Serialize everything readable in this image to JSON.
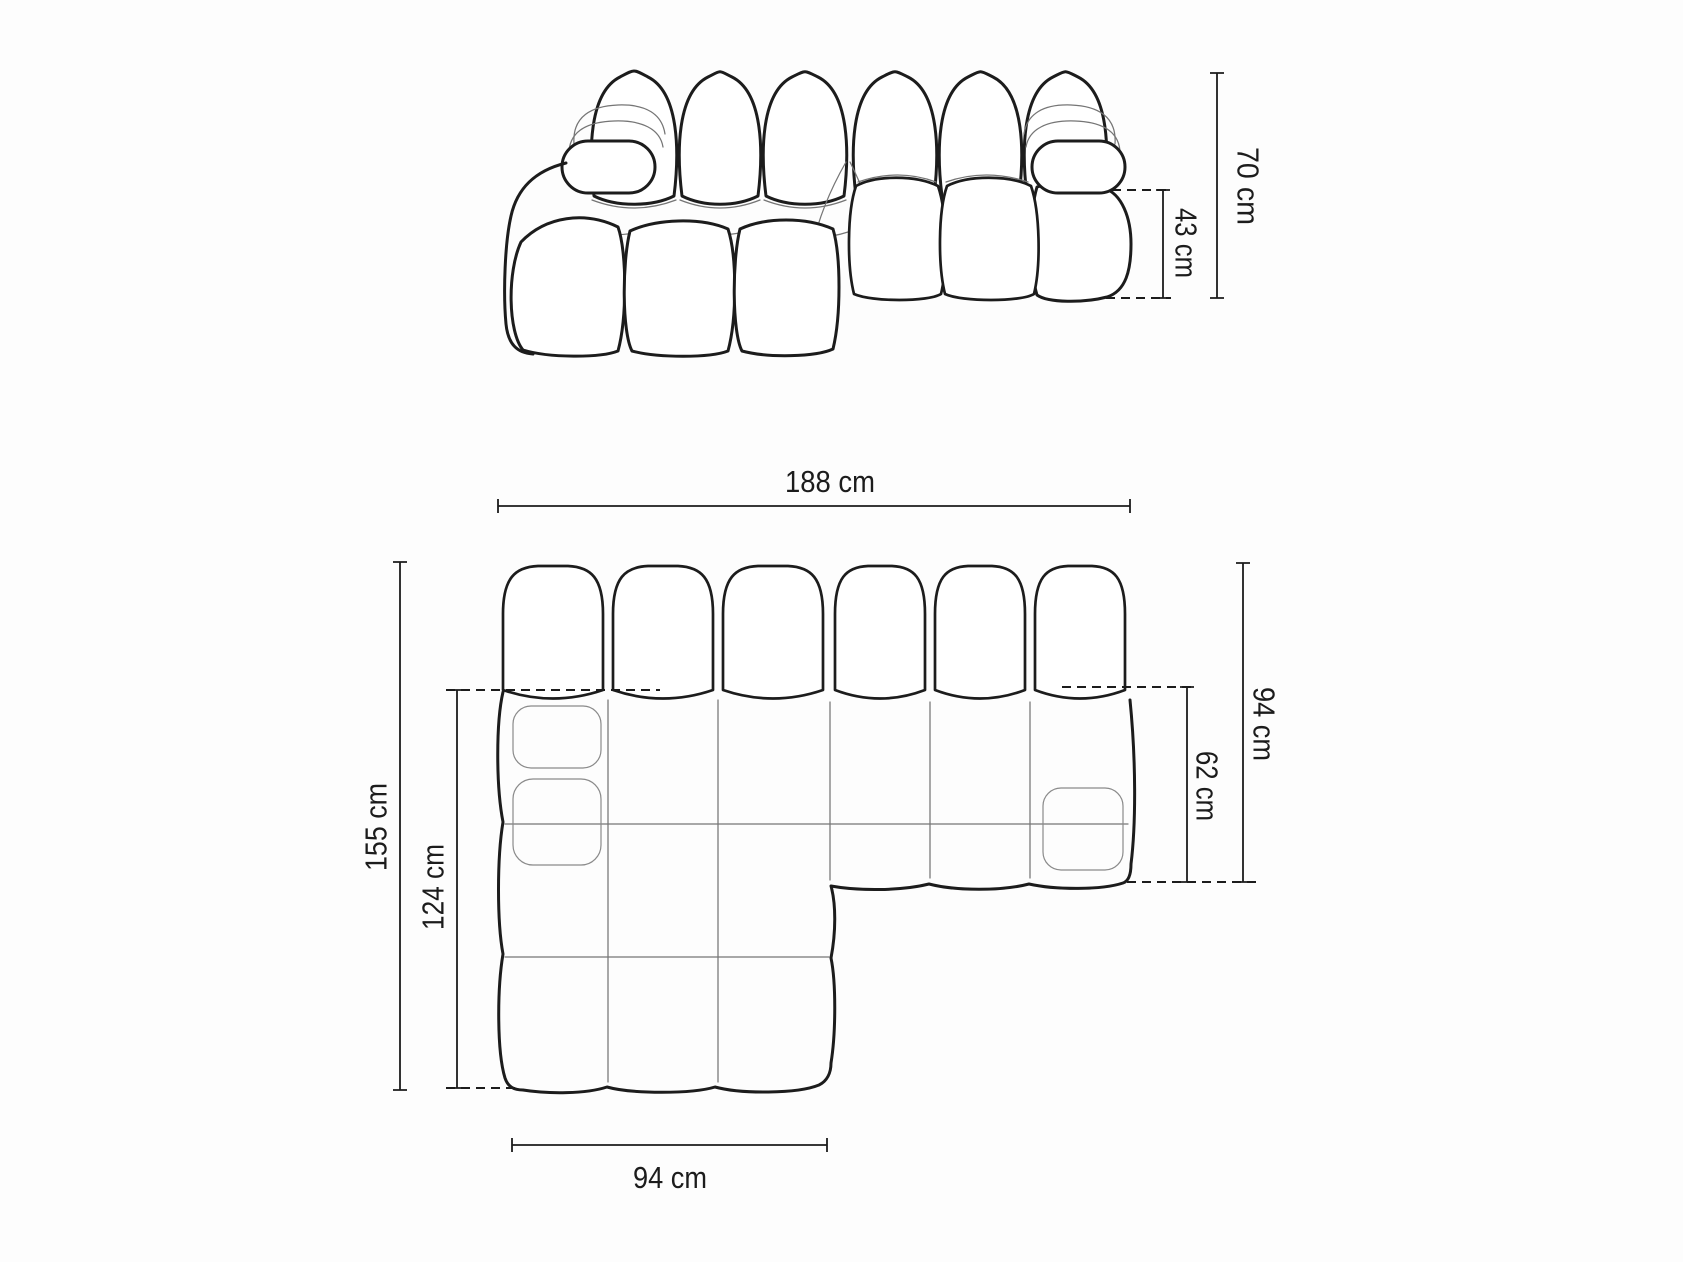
{
  "canvas": {
    "background": "#fdfdfd",
    "line_color": "#1c1c1c",
    "seam_color": "#757575",
    "text_color": "#1c1c1c"
  },
  "diagram": {
    "subject": "modular-bubble-sofa-with-left-chaise",
    "views": {
      "elevation": {
        "label": "front-elevation-view",
        "dimensions": [
          {
            "name": "total-height",
            "value": 70,
            "unit": "cm",
            "label": "70 cm"
          },
          {
            "name": "seat-height",
            "value": 43,
            "unit": "cm",
            "label": "43 cm"
          }
        ]
      },
      "plan": {
        "label": "top-plan-view",
        "dimensions": [
          {
            "name": "total-width",
            "value": 188,
            "unit": "cm",
            "label": "188 cm"
          },
          {
            "name": "total-depth",
            "value": 155,
            "unit": "cm",
            "label": "155 cm"
          },
          {
            "name": "chaise-inner-depth",
            "value": 124,
            "unit": "cm",
            "label": "124 cm"
          },
          {
            "name": "right-side-depth",
            "value": 94,
            "unit": "cm",
            "label": "94 cm"
          },
          {
            "name": "seat-depth",
            "value": 62,
            "unit": "cm",
            "label": "62 cm"
          },
          {
            "name": "chaise-width",
            "value": 94,
            "unit": "cm",
            "label": "94 cm"
          }
        ]
      }
    }
  }
}
